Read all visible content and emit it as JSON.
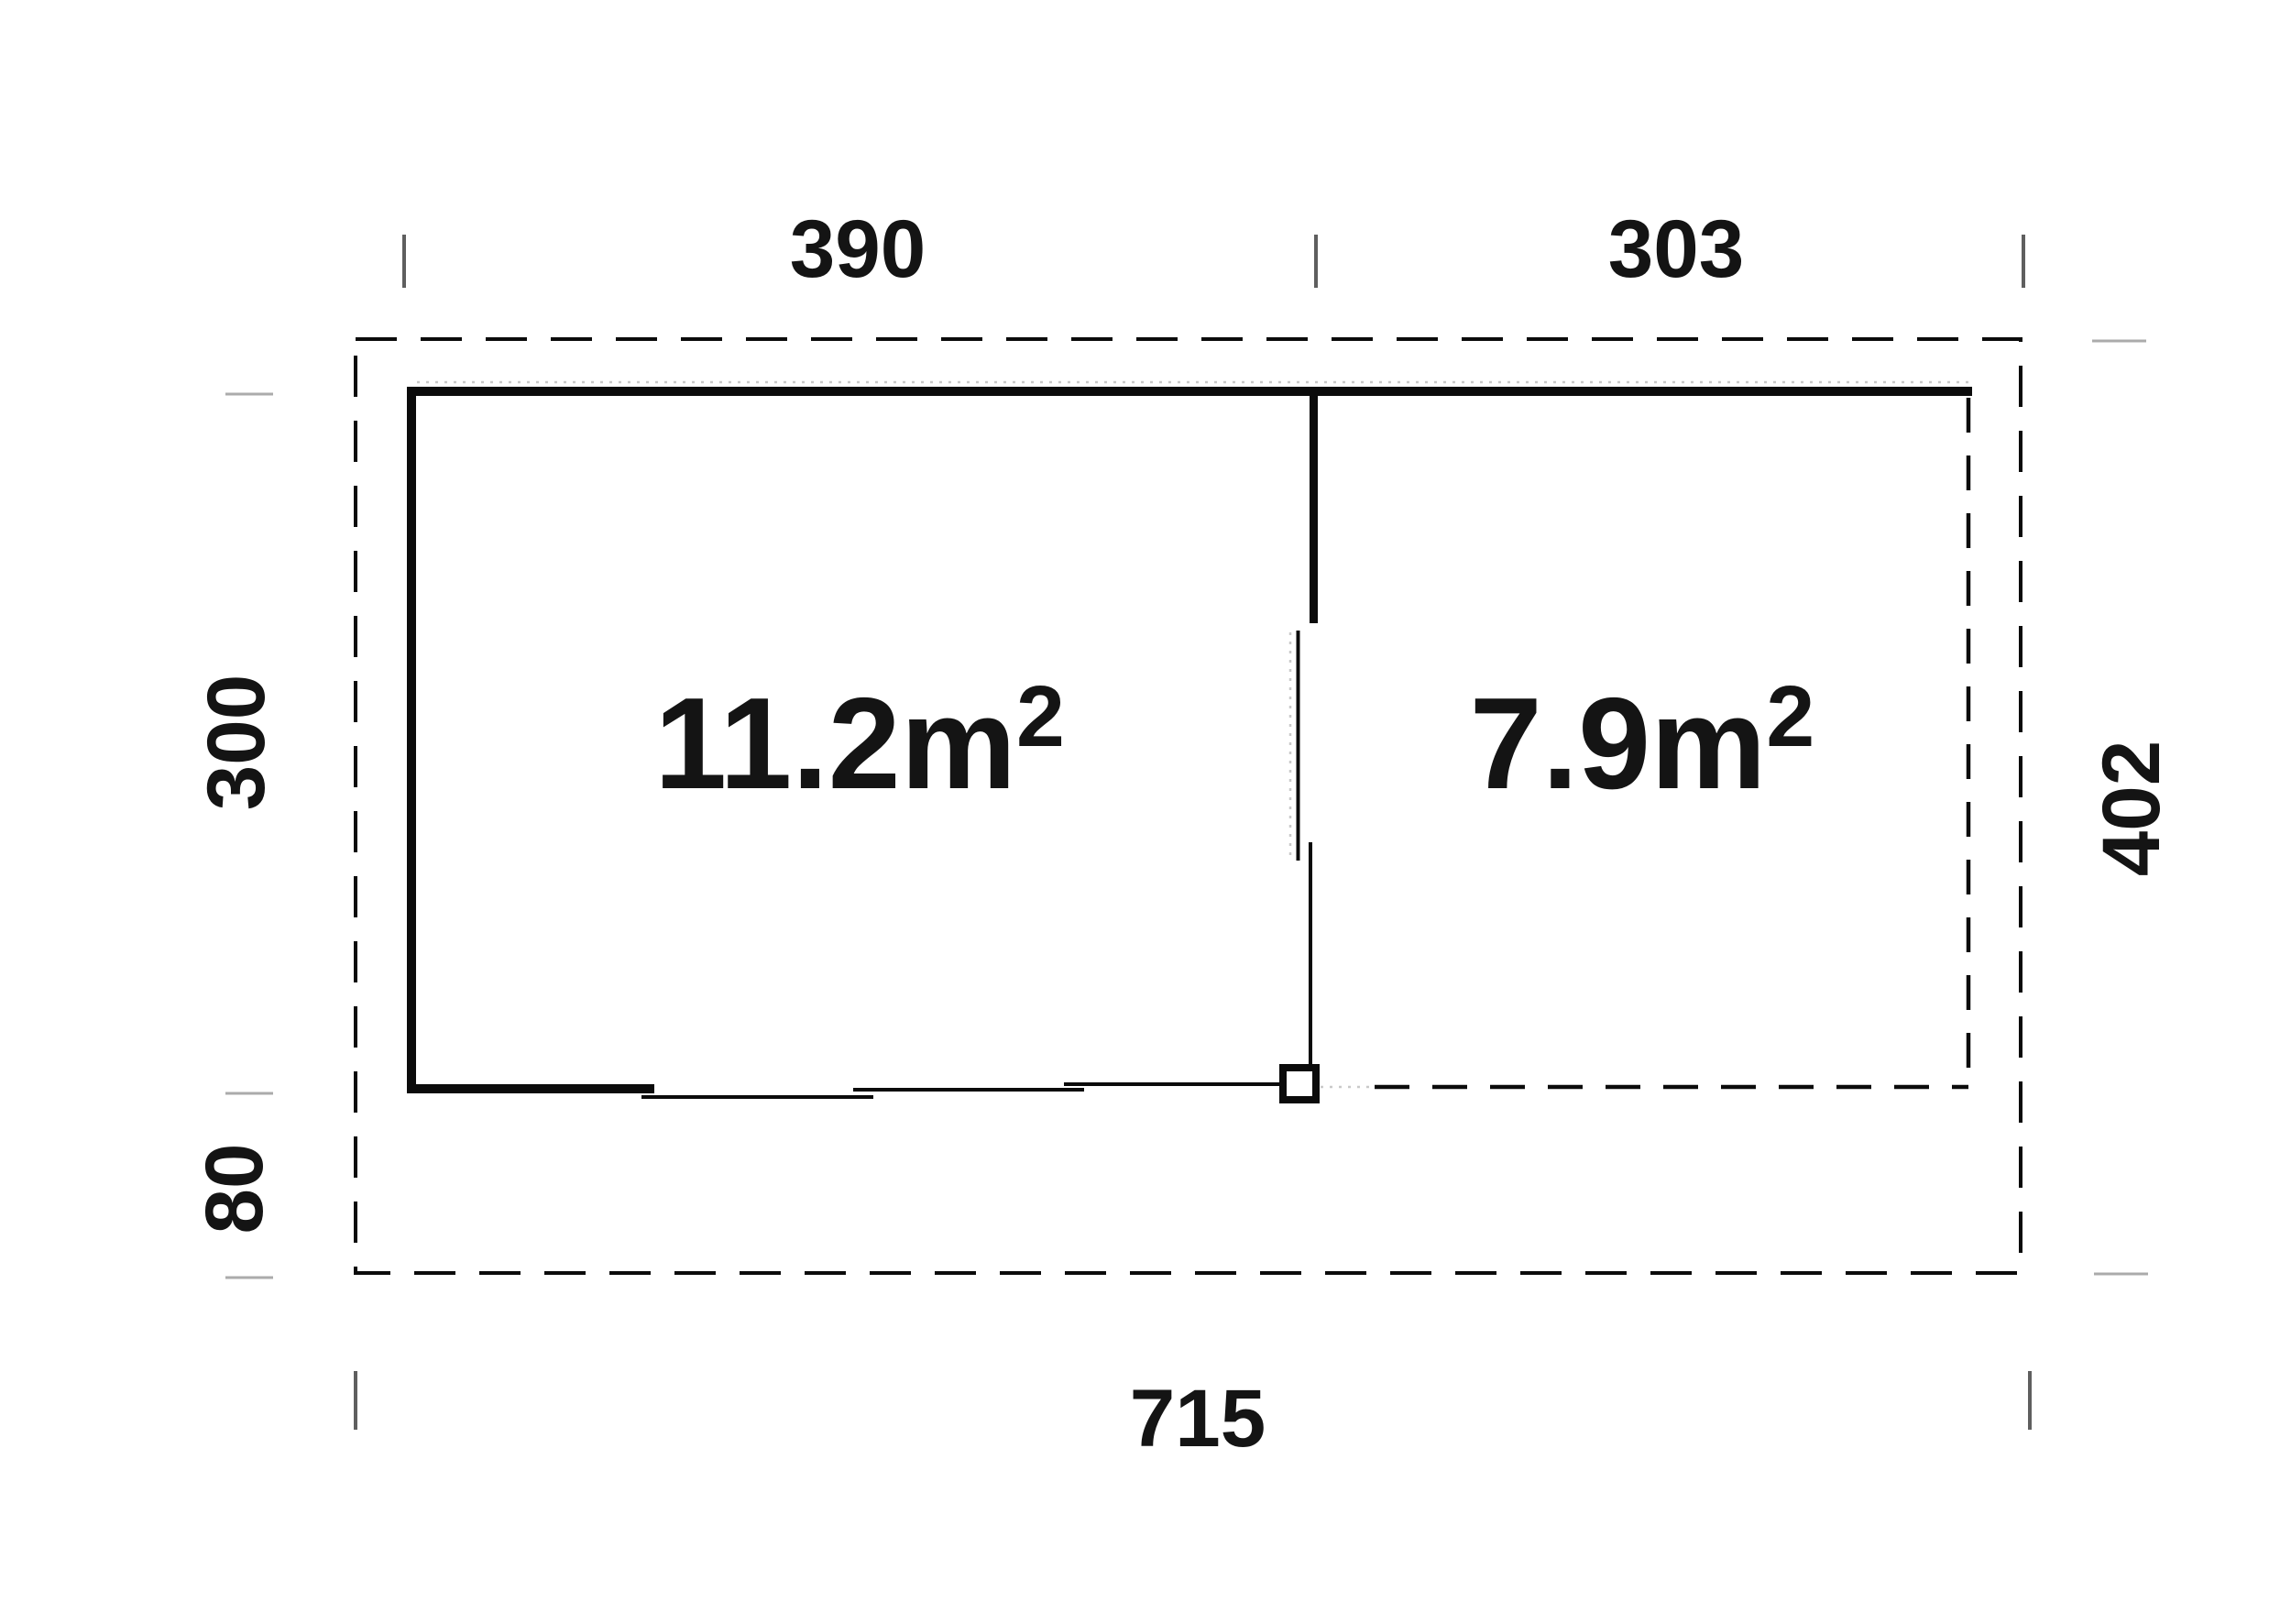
{
  "plan": {
    "type": "floor-plan",
    "rooms": [
      {
        "id": "room-left",
        "area_base": "11.2m",
        "area_sup": "2"
      },
      {
        "id": "room-right",
        "area_base": "7.9m",
        "area_sup": "2"
      }
    ],
    "dimensions": {
      "top_left_width": "390",
      "top_right_width": "303",
      "left_height": "300",
      "left_lower_offset": "80",
      "right_height": "402",
      "bottom_total_width": "715"
    },
    "colors": {
      "line": "#0b0b0b",
      "text": "#141414",
      "tick_dark": "#5f5f5f",
      "tick_light": "#ababab",
      "faint_dotted": "#c9c9c9",
      "background": "#ffffff"
    }
  }
}
